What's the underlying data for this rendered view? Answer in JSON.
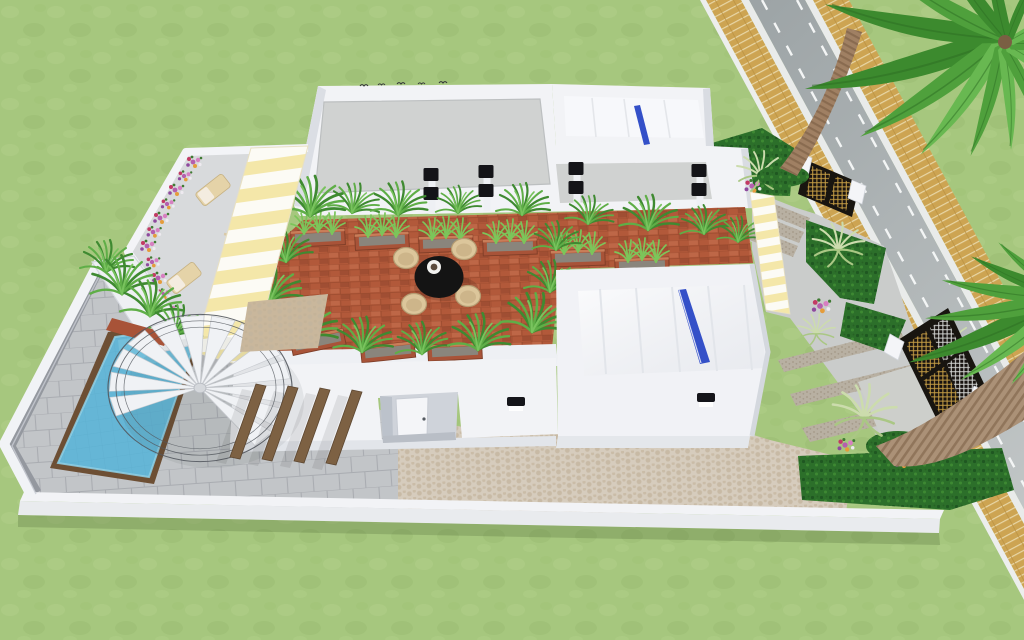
{
  "image_type": "3d-architectural-render",
  "view": "aerial-perspective-of-modern-villa-compound",
  "palette": {
    "grass": "#a6c77e",
    "grass_light": "#b4d18d",
    "grass_dark": "#96b96e",
    "road_asphalt": "#adb3b4",
    "road_dash": "#f3f5f5",
    "curb_white": "#e9ebea",
    "sidewalk_brick": "#cda452",
    "sidewalk_joint": "#e8d6a6",
    "white_wall": "#f2f3f6",
    "wall_shade": "#d9dce2",
    "wall_face": "#e7e9ed",
    "roof_deck_gray": "#d0d2d1",
    "terracotta_terrace": "#b2593a",
    "terracotta_brick_light": "#c06a49",
    "terracotta_brick_dark": "#9c4c31",
    "planter_clay": "#a85338",
    "planter_soil": "#8a857c",
    "hedge_green": "#2c6f2a",
    "hedge_dark": "#1e5420",
    "hedge_light": "#3f8c33",
    "fern_green_dark": "#3f8a31",
    "fern_green_mid": "#5fae47",
    "fern_green_light": "#79c35e",
    "agave_pale": "#ccdcad",
    "palm_frond_dark": "#3c8a2e",
    "palm_frond_mid": "#4fa03c",
    "palm_frond_light": "#68b851",
    "palm_trunk": "#a08063",
    "palm_trunk_ring": "#85674c",
    "palm2_trunk": "#ab9177",
    "palm2_trunk_ring": "#8d7258",
    "pool_water": "#65b6d6",
    "pool_water_light": "#8fd0e6",
    "pool_wood_trim": "#6d4f34",
    "paver_gray": "#c2c5c8",
    "paver_joint": "#a9acb1",
    "paver_dark_band": "#94989f",
    "cobblestone_beige": "#d6ccbd",
    "cobblestone_dot": "#c3b49d",
    "concrete_path": "#cacccb",
    "speckle_band": "#b8b0a2",
    "awning_yellow": "#f4e7a9",
    "awning_white": "#fcfbf5",
    "gate_frame_black": "#181510",
    "gate_mesh_gold": "#c79f45",
    "gate_mesh_silver": "#d7d8d6",
    "skylight_blue": "#3450c8",
    "dining_table_black": "#141414",
    "wicker_beige": "#dcc69b",
    "lounger_beige": "#e5d3a8",
    "pergola_wood": "#7d6143",
    "flower_purple": "#b55fae",
    "flower_pink": "#d77fc1",
    "flower_magenta": "#c23a64",
    "flower_orange": "#e59c3b",
    "sconce_black": "#141418"
  },
  "scene": {
    "environment": {
      "ground": "lawn",
      "road": {
        "dashed_lane_lines": 2,
        "sidewalks": 2,
        "direction": "diagonal-top-to-bottom-right"
      }
    },
    "villa": {
      "roof_deck": {
        "floor": "gray concrete",
        "parapet": "white"
      },
      "skylight_roofs": 2,
      "skylight_strips": 2,
      "rooftop_terrace": {
        "floor": "terracotta brick",
        "dining_set": {
          "tables": 1,
          "chairs": 4,
          "plate_on_table": 1
        },
        "planter_boxes": 10,
        "fern_clusters": 18
      },
      "flower_terrace": {
        "flower_clusters": 12,
        "lounge_chairs": 2
      },
      "striped_awnings": 2,
      "pool": {
        "shape": "rectangular",
        "wood_trim": true
      },
      "spiral_staircase": {
        "treads": 13,
        "railing_rings": 3
      },
      "pergola_beams": 4,
      "wall_sconces": 4,
      "step_lights": 2,
      "birds_on_parapet": 5,
      "entry_door": 1
    },
    "landscaping": {
      "palm_trees": 2,
      "hedge_blocks": 5,
      "agave_plants": 5,
      "flower_patches": 4
    },
    "gates": {
      "count": 2,
      "style": "black frame with gold and silver mesh panels",
      "white_posts": 4
    }
  }
}
